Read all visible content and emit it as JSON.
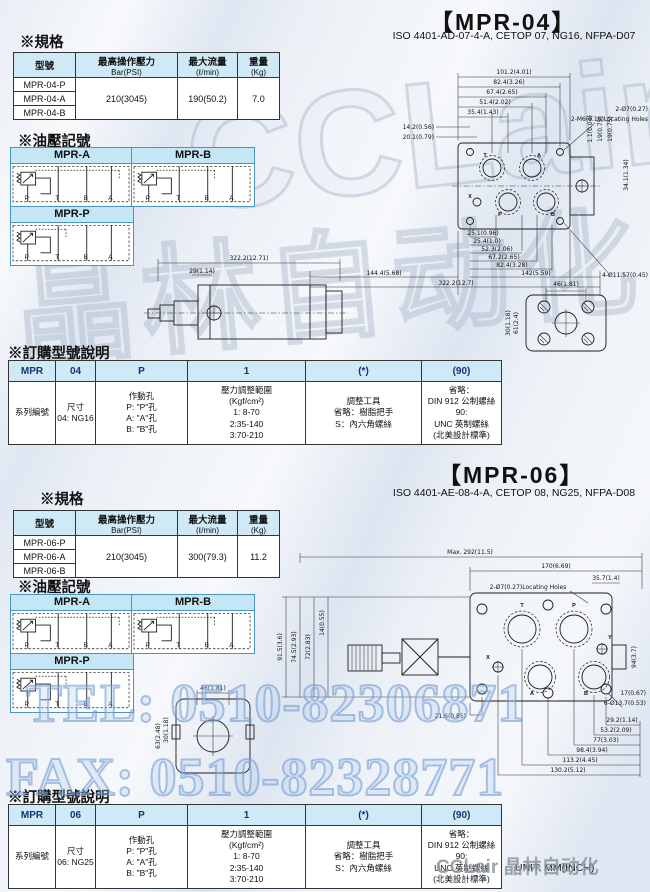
{
  "watermarks": {
    "brand_latin": "CCLair",
    "brand_cn": "晶林自动化",
    "tel": "TEL: 0510-82306871",
    "fax": "FAX: 0510-82328771"
  },
  "footer": {
    "brand": "CCLair 晶林自动化",
    "unit": "UNIT: MM(INCH)"
  },
  "symbols": {
    "ports": [
      "P",
      "T",
      "B",
      "A"
    ]
  },
  "mpr04": {
    "title": "【MPR-04】",
    "subtitle": "ISO 4401-AD-07-4-A, CETOP 07, NG16, NFPA-D07",
    "spec_heading": "※規格",
    "symbols_heading": "※油壓記號",
    "order_heading": "※訂購型號說明",
    "spec": {
      "col_model": "型號",
      "col_pressure": "最高操作壓力",
      "col_pressure_unit": "Bar(PSI)",
      "col_flow": "最大流量",
      "col_flow_unit": "(ℓ/min)",
      "col_weight": "重量",
      "col_weight_unit": "(Kg)",
      "models": [
        "MPR-04-P",
        "MPR-04-A",
        "MPR-04-B"
      ],
      "pressure": "210(3045)",
      "flow": "190(50.2)",
      "weight": "7.0"
    },
    "symbols": {
      "a": "MPR-A",
      "b": "MPR-B",
      "p": "MPR-P"
    },
    "order": {
      "codes": [
        "MPR",
        "04",
        "P",
        "1",
        "(*)",
        "(90)"
      ],
      "series": "系列編號",
      "size": "尺寸\n04: NG16",
      "port": "作動孔\nP: \"P\"孔\nA: \"A\"孔\nB: \"B\"孔",
      "range": "壓力調整範圍\n(Kgf/cm²)\n1: 8-70\n2:35-140\n3:70-210",
      "tool": "調整工具\n省略：樹脂把手\nS：內六角螺絲",
      "screw": "省略：\nDIN 912 公制螺絲\n90:\nUNC 英制螺絲\n(北美設計標準)"
    },
    "ports": [
      "T",
      "A",
      "P",
      "B",
      "X"
    ],
    "dims": [
      "101.2(4.01)",
      "82.4(3.26)",
      "67.4(2.65)",
      "51.4(2.02)",
      "35.4(1.43)",
      "14.2(0.56)",
      "20.1(0.79)",
      "2-Ø7(0.27)",
      "2-M6(0.16)Locating Holes",
      "34.1(1.34)",
      "25.1(0.96)",
      "25.4(1.0)",
      "52.3(2.06)",
      "67.2(2.65)",
      "82.4(3.28)",
      "144.4(5.68)",
      "142(5.59)",
      "322.2(12.7)",
      "4-Ø11.57(0.45)",
      "322.2(12.71)",
      "29(1.14)",
      "46(1.81)",
      "61(2.4)",
      "30(1.18)",
      "1.1(0.04)",
      "19(0.75)",
      "19(0.75)"
    ]
  },
  "mpr06": {
    "title": "【MPR-06】",
    "subtitle": "ISO 4401-AE-08-4-A, CETOP 08, NG25, NFPA-D08",
    "spec_heading": "※規格",
    "symbols_heading": "※油壓記號",
    "order_heading": "※訂購型號說明",
    "spec": {
      "col_model": "型號",
      "col_pressure": "最高操作壓力",
      "col_pressure_unit": "Bar(PSI)",
      "col_flow": "最大流量",
      "col_flow_unit": "(ℓ/min)",
      "col_weight": "重量",
      "col_weight_unit": "(Kg)",
      "models": [
        "MPR-06-P",
        "MPR-06-A",
        "MPR-06-B"
      ],
      "pressure": "210(3045)",
      "flow": "300(79.3)",
      "weight": "11.2"
    },
    "symbols": {
      "a": "MPR-A",
      "b": "MPR-B",
      "p": "MPR-P"
    },
    "order": {
      "codes": [
        "MPR",
        "06",
        "P",
        "1",
        "(*)",
        "(90)"
      ],
      "series": "系列編號",
      "size": "尺寸\n06: NG25",
      "port": "作動孔\nP: \"P\"孔\nA: \"A\"孔\nB: \"B\"孔",
      "range": "壓力調整範圍\n(Kgf/cm²)\n1: 8-70\n2:35-140\n3:70-210",
      "tool": "調整工具\n省略：樹脂把手\nS：內六角螺絲",
      "screw": "省略：\nDIN 912 公制螺絲\n90:\nUNC 英制螺絲\n(北美設計標準)"
    },
    "ports": [
      "T",
      "P",
      "X",
      "Y",
      "A",
      "B"
    ],
    "dims": [
      "Max. 292(11.5)",
      "170(6.69)",
      "35.7(1.4)",
      "2-Ø7(0.27)Locating Holes",
      "91.5(3.6)",
      "74.5(2.93)",
      "72(2.83)",
      "14(0.55)",
      "94(3.7)",
      "21.6(0.85)",
      "29.2(1.14)",
      "53.2(2.09)",
      "77(3.03)",
      "98.4(3.94)",
      "113.2(4.45)",
      "130.2(5.12)",
      "6-Ø13.7(0.53)",
      "17(0.67)",
      "46(1.81)",
      "63(2.48)",
      "30(1.18)"
    ]
  }
}
